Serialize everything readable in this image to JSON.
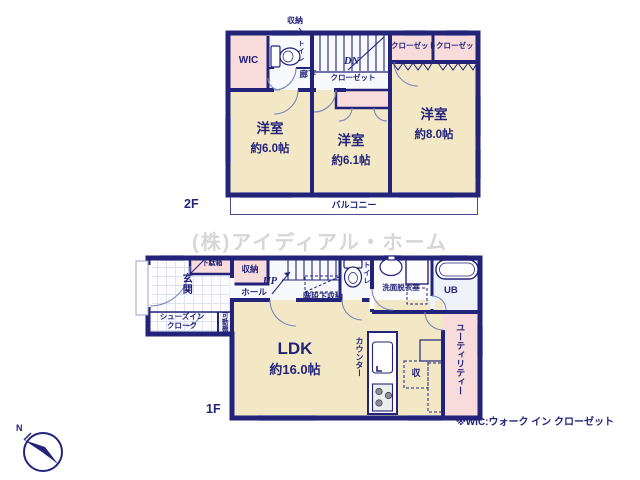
{
  "watermark": "(株)アイディアル・ホーム",
  "footnote": "※WIC:ウォーク イン クローゼット",
  "compass_n": "N",
  "floor2": {
    "floor_label": "2F",
    "storage": "収納",
    "wic": "WIC",
    "toilet": "トイレ",
    "hallway": "廊下",
    "stairs_dn": "DN",
    "closet_hall": "クローゼット",
    "closet_right_1": "クローゼット",
    "closet_right_2": "クローゼット",
    "bedroom_left": {
      "name": "洋室",
      "size": "約6.0帖"
    },
    "bedroom_center": {
      "name": "洋室",
      "size": "約6.1帖"
    },
    "bedroom_right": {
      "name": "洋室",
      "size": "約8.0帖"
    },
    "balcony": "バルコニー"
  },
  "floor1": {
    "floor_label": "1F",
    "shoe_cabinet": "下駄箱",
    "entrance": "玄関",
    "shoes_closet_line1": "シューズイン",
    "shoes_closet_line2": "クローク",
    "movable_shelf": "可動棚",
    "storage": "収納",
    "hall": "ホール",
    "stairs_up": "UP",
    "under_stair_storage": "階段下収納",
    "toilet": "トイレ",
    "washroom": "洗面脱衣室",
    "bath": "UB",
    "ldk": {
      "name": "LDK",
      "size": "約16.0帖"
    },
    "counter": "カウンター",
    "storage_small": "収",
    "utility": "ユーティリティー"
  }
}
